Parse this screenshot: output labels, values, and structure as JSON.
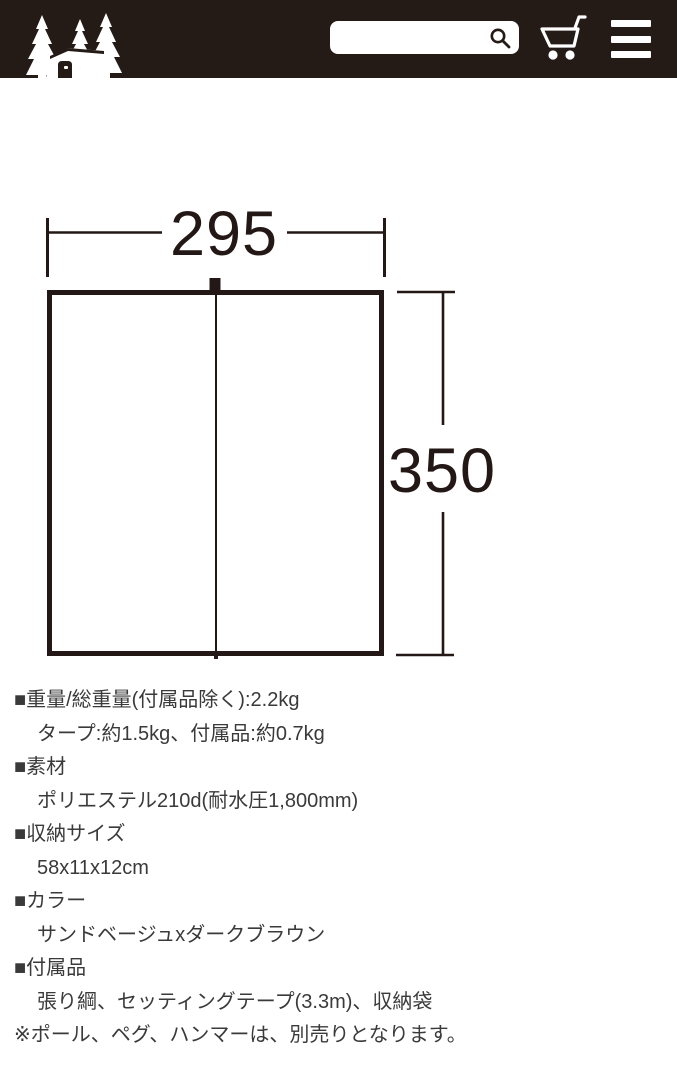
{
  "header": {
    "logo_name": "tent-and-trees-logo",
    "search": {
      "value": ""
    },
    "icons": {
      "search": "magnifier",
      "cart": "shopping-cart",
      "menu": "hamburger"
    }
  },
  "colors": {
    "header_bg": "#241a16",
    "icon": "#ffffff",
    "diagram_line": "#231815",
    "text": "#3a3a3a"
  },
  "diagram": {
    "type": "tarp-dimension-drawing",
    "width_label": "295",
    "height_label": "350"
  },
  "specs": {
    "lines": [
      {
        "text": "■重量/総重量(付属品除く):2.2kg",
        "indent": false
      },
      {
        "text": "タープ:約1.5kg、付属品:約0.7kg",
        "indent": true
      },
      {
        "text": "■素材",
        "indent": false
      },
      {
        "text": "ポリエステル210d(耐水圧1,800mm)",
        "indent": true
      },
      {
        "text": "■収納サイズ",
        "indent": false
      },
      {
        "text": "58x11x12cm",
        "indent": true
      },
      {
        "text": "■カラー",
        "indent": false
      },
      {
        "text": "サンドベージュxダークブラウン",
        "indent": true
      },
      {
        "text": "■付属品",
        "indent": false
      },
      {
        "text": "張り綱、セッティングテープ(3.3m)、収納袋",
        "indent": true
      },
      {
        "text": "※ポール、ペグ、ハンマーは、別売りとなります。",
        "indent": false
      }
    ]
  }
}
